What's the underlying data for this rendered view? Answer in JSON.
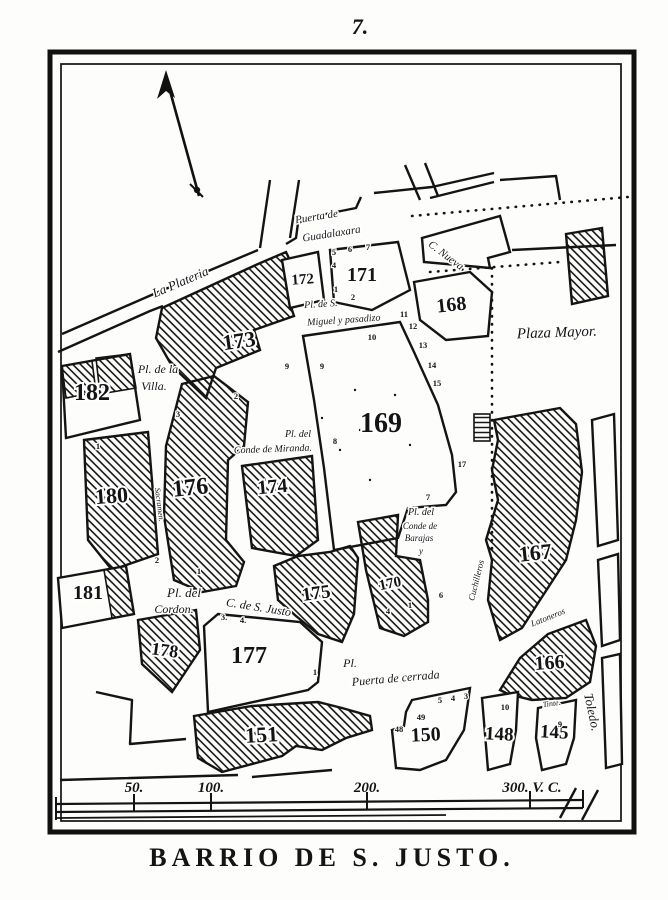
{
  "page": {
    "number": "7.",
    "title": "BARRIO DE S. JUSTO."
  },
  "icons": {
    "north_arrow": "north-arrow"
  },
  "scale_bar": {
    "marks": [
      {
        "label": "50.",
        "x": 134
      },
      {
        "label": "100.",
        "x": 211
      },
      {
        "label": "200.",
        "x": 367
      },
      {
        "label": "300. V. C.",
        "x": 532
      }
    ]
  },
  "map": {
    "blocks": [
      {
        "n": "182",
        "x": 92,
        "y": 400,
        "s": 24,
        "r": 0
      },
      {
        "n": "180",
        "x": 112,
        "y": 503,
        "s": 22,
        "r": -4
      },
      {
        "n": "181",
        "x": 88,
        "y": 599,
        "s": 20,
        "r": 0
      },
      {
        "n": "178",
        "x": 164,
        "y": 656,
        "s": 18,
        "r": 8
      },
      {
        "n": "176",
        "x": 191,
        "y": 495,
        "s": 24,
        "r": -6
      },
      {
        "n": "174",
        "x": 273,
        "y": 493,
        "s": 20,
        "r": -5
      },
      {
        "n": "173",
        "x": 240,
        "y": 348,
        "s": 22,
        "r": -8
      },
      {
        "n": "172",
        "x": 303,
        "y": 284,
        "s": 15,
        "r": -4
      },
      {
        "n": "171",
        "x": 362,
        "y": 281,
        "s": 20,
        "r": 0
      },
      {
        "n": "175",
        "x": 317,
        "y": 599,
        "s": 19,
        "r": -8
      },
      {
        "n": "170",
        "x": 391,
        "y": 588,
        "s": 15,
        "r": -12
      },
      {
        "n": "169",
        "x": 381,
        "y": 432,
        "s": 28,
        "r": 0
      },
      {
        "n": "168",
        "x": 452,
        "y": 311,
        "s": 20,
        "r": -6
      },
      {
        "n": "167",
        "x": 536,
        "y": 560,
        "s": 22,
        "r": -6
      },
      {
        "n": "166",
        "x": 550,
        "y": 669,
        "s": 20,
        "r": -4
      },
      {
        "n": "177",
        "x": 249,
        "y": 663,
        "s": 24,
        "r": 0
      },
      {
        "n": "151",
        "x": 262,
        "y": 742,
        "s": 22,
        "r": -3
      },
      {
        "n": "150",
        "x": 426,
        "y": 741,
        "s": 20,
        "r": -3
      },
      {
        "n": "148",
        "x": 499,
        "y": 740,
        "s": 19,
        "r": 3
      },
      {
        "n": "145",
        "x": 554,
        "y": 738,
        "s": 19,
        "r": 3
      }
    ],
    "streets": [
      {
        "id": "la-plateria",
        "t": "La Plateria",
        "x": 182,
        "y": 286,
        "r": -23,
        "s": 13
      },
      {
        "id": "puerta-de",
        "t": "Puerta de",
        "x": 317,
        "y": 220,
        "r": -9,
        "s": 11
      },
      {
        "id": "guadalaxara",
        "t": "Guadalaxara",
        "x": 332,
        "y": 237,
        "r": -9,
        "s": 11
      },
      {
        "id": "c-nueva",
        "t": "C. Nueva",
        "x": 444,
        "y": 258,
        "r": 37,
        "s": 11
      },
      {
        "id": "plaza-mayor",
        "t": "Plaza Mayor.",
        "x": 557,
        "y": 337,
        "r": -2,
        "s": 15
      },
      {
        "id": "pl-de-la",
        "t": "Pl. de la",
        "x": 158,
        "y": 373,
        "r": 0,
        "s": 12
      },
      {
        "id": "villa",
        "t": "Villa.",
        "x": 154,
        "y": 390,
        "r": 0,
        "s": 12
      },
      {
        "id": "pl-de-s",
        "t": "Pl. de S.",
        "x": 321,
        "y": 307,
        "r": -4,
        "s": 10
      },
      {
        "id": "miguel-pasadizo",
        "t": "Miguel y pasadizo",
        "x": 344,
        "y": 323,
        "r": -4,
        "s": 10
      },
      {
        "id": "pl-del-miranda",
        "t": "Pl. del",
        "x": 298,
        "y": 437,
        "r": 0,
        "s": 10
      },
      {
        "id": "conde-miranda",
        "t": "Conde de Miranda.",
        "x": 273,
        "y": 452,
        "r": -2,
        "s": 10
      },
      {
        "id": "pl-del-barajas",
        "t": "Pl. del",
        "x": 421,
        "y": 515,
        "r": 0,
        "s": 10
      },
      {
        "id": "conde-de",
        "t": "Conde de",
        "x": 420,
        "y": 529,
        "r": 0,
        "s": 9
      },
      {
        "id": "barajas",
        "t": "Barajas",
        "x": 419,
        "y": 541,
        "r": 0,
        "s": 9
      },
      {
        "id": "barajas-y",
        "t": "y",
        "x": 421,
        "y": 554,
        "r": 0,
        "s": 9
      },
      {
        "id": "pl-del-cordon",
        "t": "Pl.  del",
        "x": 184,
        "y": 597,
        "r": 0,
        "s": 13
      },
      {
        "id": "cordon",
        "t": "Cordon.",
        "x": 174,
        "y": 613,
        "r": 0,
        "s": 12
      },
      {
        "id": "c-s-justo",
        "t": "C. de S. Justo",
        "x": 258,
        "y": 611,
        "r": 9,
        "s": 12
      },
      {
        "id": "pl-cerrada",
        "t": "Pl.",
        "x": 350,
        "y": 667,
        "r": 0,
        "s": 12
      },
      {
        "id": "puerta-cerrada",
        "t": "Puerta de cerrada",
        "x": 396,
        "y": 682,
        "r": -5,
        "s": 12
      },
      {
        "id": "toledo",
        "t": "Toledo.",
        "x": 588,
        "y": 713,
        "r": 78,
        "s": 13
      },
      {
        "id": "cuchilleros",
        "t": "Cuchilleros",
        "x": 479,
        "y": 581,
        "r": -76,
        "s": 9
      },
      {
        "id": "latoneros",
        "t": "Latoneros",
        "x": 549,
        "y": 620,
        "r": -22,
        "s": 9
      },
      {
        "id": "sacramen",
        "t": "Sacramen.",
        "x": 157,
        "y": 505,
        "r": 83,
        "s": 8
      },
      {
        "id": "tinte",
        "t": "Tinte.",
        "x": 552,
        "y": 706,
        "r": -8,
        "s": 8
      }
    ],
    "lot_numbers": [
      {
        "t": "5",
        "x": 334,
        "y": 255
      },
      {
        "t": "6",
        "x": 350,
        "y": 252
      },
      {
        "t": "7",
        "x": 368,
        "y": 250
      },
      {
        "t": "4",
        "x": 334,
        "y": 268
      },
      {
        "t": "1",
        "x": 336,
        "y": 292
      },
      {
        "t": "2",
        "x": 353,
        "y": 300
      },
      {
        "t": "9",
        "x": 287,
        "y": 369
      },
      {
        "t": "9",
        "x": 322,
        "y": 369
      },
      {
        "t": "10",
        "x": 372,
        "y": 340
      },
      {
        "t": "2",
        "x": 236,
        "y": 399
      },
      {
        "t": "3",
        "x": 178,
        "y": 417
      },
      {
        "t": "11",
        "x": 404,
        "y": 317
      },
      {
        "t": "12",
        "x": 413,
        "y": 329
      },
      {
        "t": "13",
        "x": 423,
        "y": 348
      },
      {
        "t": "14",
        "x": 432,
        "y": 368
      },
      {
        "t": "15",
        "x": 437,
        "y": 386
      },
      {
        "t": "17",
        "x": 462,
        "y": 467
      },
      {
        "t": "8",
        "x": 335,
        "y": 444
      },
      {
        "t": "2",
        "x": 157,
        "y": 563
      },
      {
        "t": "1",
        "x": 199,
        "y": 574
      },
      {
        "t": "1",
        "x": 98,
        "y": 449
      },
      {
        "t": "7",
        "x": 428,
        "y": 500
      },
      {
        "t": "4",
        "x": 388,
        "y": 614
      },
      {
        "t": "1",
        "x": 410,
        "y": 608
      },
      {
        "t": "6",
        "x": 441,
        "y": 598
      },
      {
        "t": "3.",
        "x": 224,
        "y": 620
      },
      {
        "t": "4.",
        "x": 243,
        "y": 623
      },
      {
        "t": "1",
        "x": 315,
        "y": 675
      },
      {
        "t": "48",
        "x": 399,
        "y": 732
      },
      {
        "t": "49",
        "x": 421,
        "y": 720
      },
      {
        "t": "5",
        "x": 440,
        "y": 703
      },
      {
        "t": "4",
        "x": 453,
        "y": 701
      },
      {
        "t": "3",
        "x": 466,
        "y": 699
      },
      {
        "t": "10",
        "x": 505,
        "y": 710
      },
      {
        "t": "9",
        "x": 560,
        "y": 727
      }
    ]
  }
}
